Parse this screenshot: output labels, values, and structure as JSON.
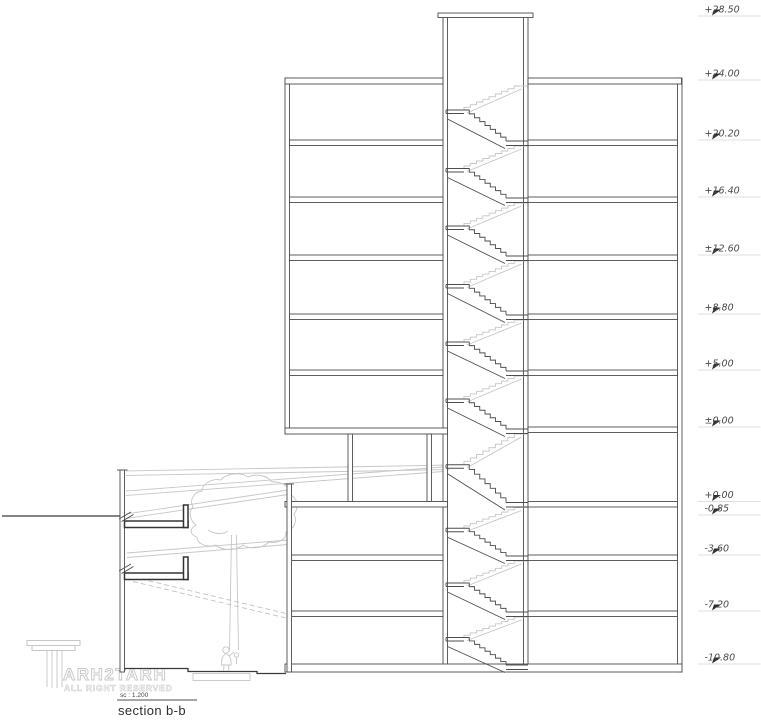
{
  "drawing": {
    "title": "section b-b",
    "scale_label": "sc : 1.200",
    "levels": [
      {
        "label": "+28.50",
        "y": 16
      },
      {
        "label": "+24.00",
        "y": 80
      },
      {
        "label": "+20.20",
        "y": 140
      },
      {
        "label": "+16.40",
        "y": 197
      },
      {
        "label": "±12.60",
        "y": 255
      },
      {
        "label": "+8.80",
        "y": 314
      },
      {
        "label": "+5.00",
        "y": 370
      },
      {
        "label": "±0.00",
        "y": 427
      },
      {
        "label": "+0.00",
        "y": 501.5
      },
      {
        "label": "-0.85",
        "y": 515
      },
      {
        "label": "-3.60",
        "y": 555
      },
      {
        "label": "-7.20",
        "y": 611
      },
      {
        "label": "-10.80",
        "y": 664
      }
    ],
    "floor_lines": [
      80,
      140,
      197,
      255,
      314,
      370,
      428,
      501.5,
      555,
      611,
      664
    ],
    "colors": {
      "line": "#4d4d4d",
      "dark": "#3a3a3a",
      "light": "#c6c6c6",
      "level_underline": "#d4d4d4",
      "marker": "#2b2b2b",
      "background": "#ffffff"
    }
  },
  "logo": {
    "name": "ARH2TARH",
    "tagline": "ALL RIGHT RESERVED"
  }
}
